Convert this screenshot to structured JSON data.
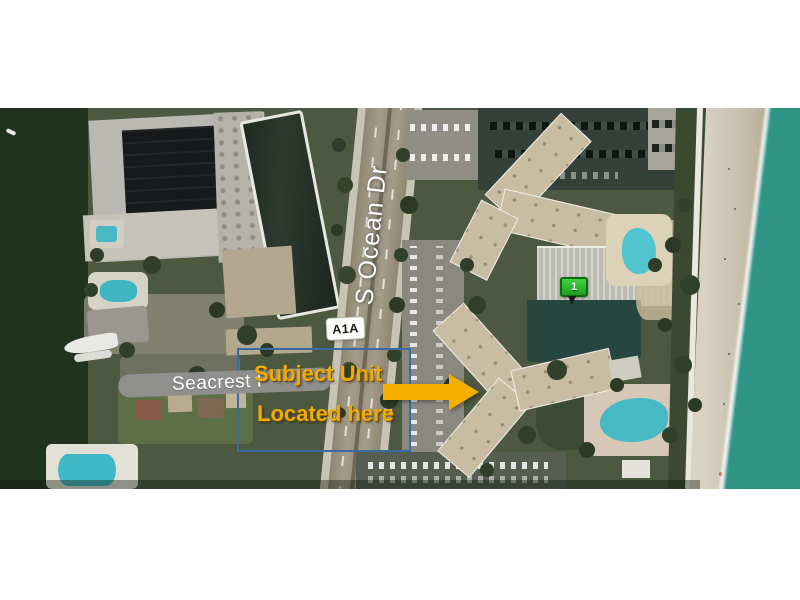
{
  "image_type": "aerial satellite photo with real-estate location annotations",
  "labels": {
    "main_road": "S Ocean Dr",
    "route_shield": "A1A",
    "cross_street": "Seacrest P",
    "callout_line1": "Subject Unit",
    "callout_line2": "Located here",
    "marker": "1"
  },
  "colors": {
    "callout_text": "#EFAC00",
    "arrow": "#F6AE00",
    "highlight_box_border": "#3A6BA8",
    "street_pill": "#919191",
    "route_shield_bg": "#FCFCF8",
    "marker_green": "#2FC32F",
    "ocean": "#38A18D",
    "inland_water": "#20331E",
    "beach_sand": "#D3CCBE",
    "road_surface": "#A3997F",
    "page_background": "#FFFFFF"
  }
}
